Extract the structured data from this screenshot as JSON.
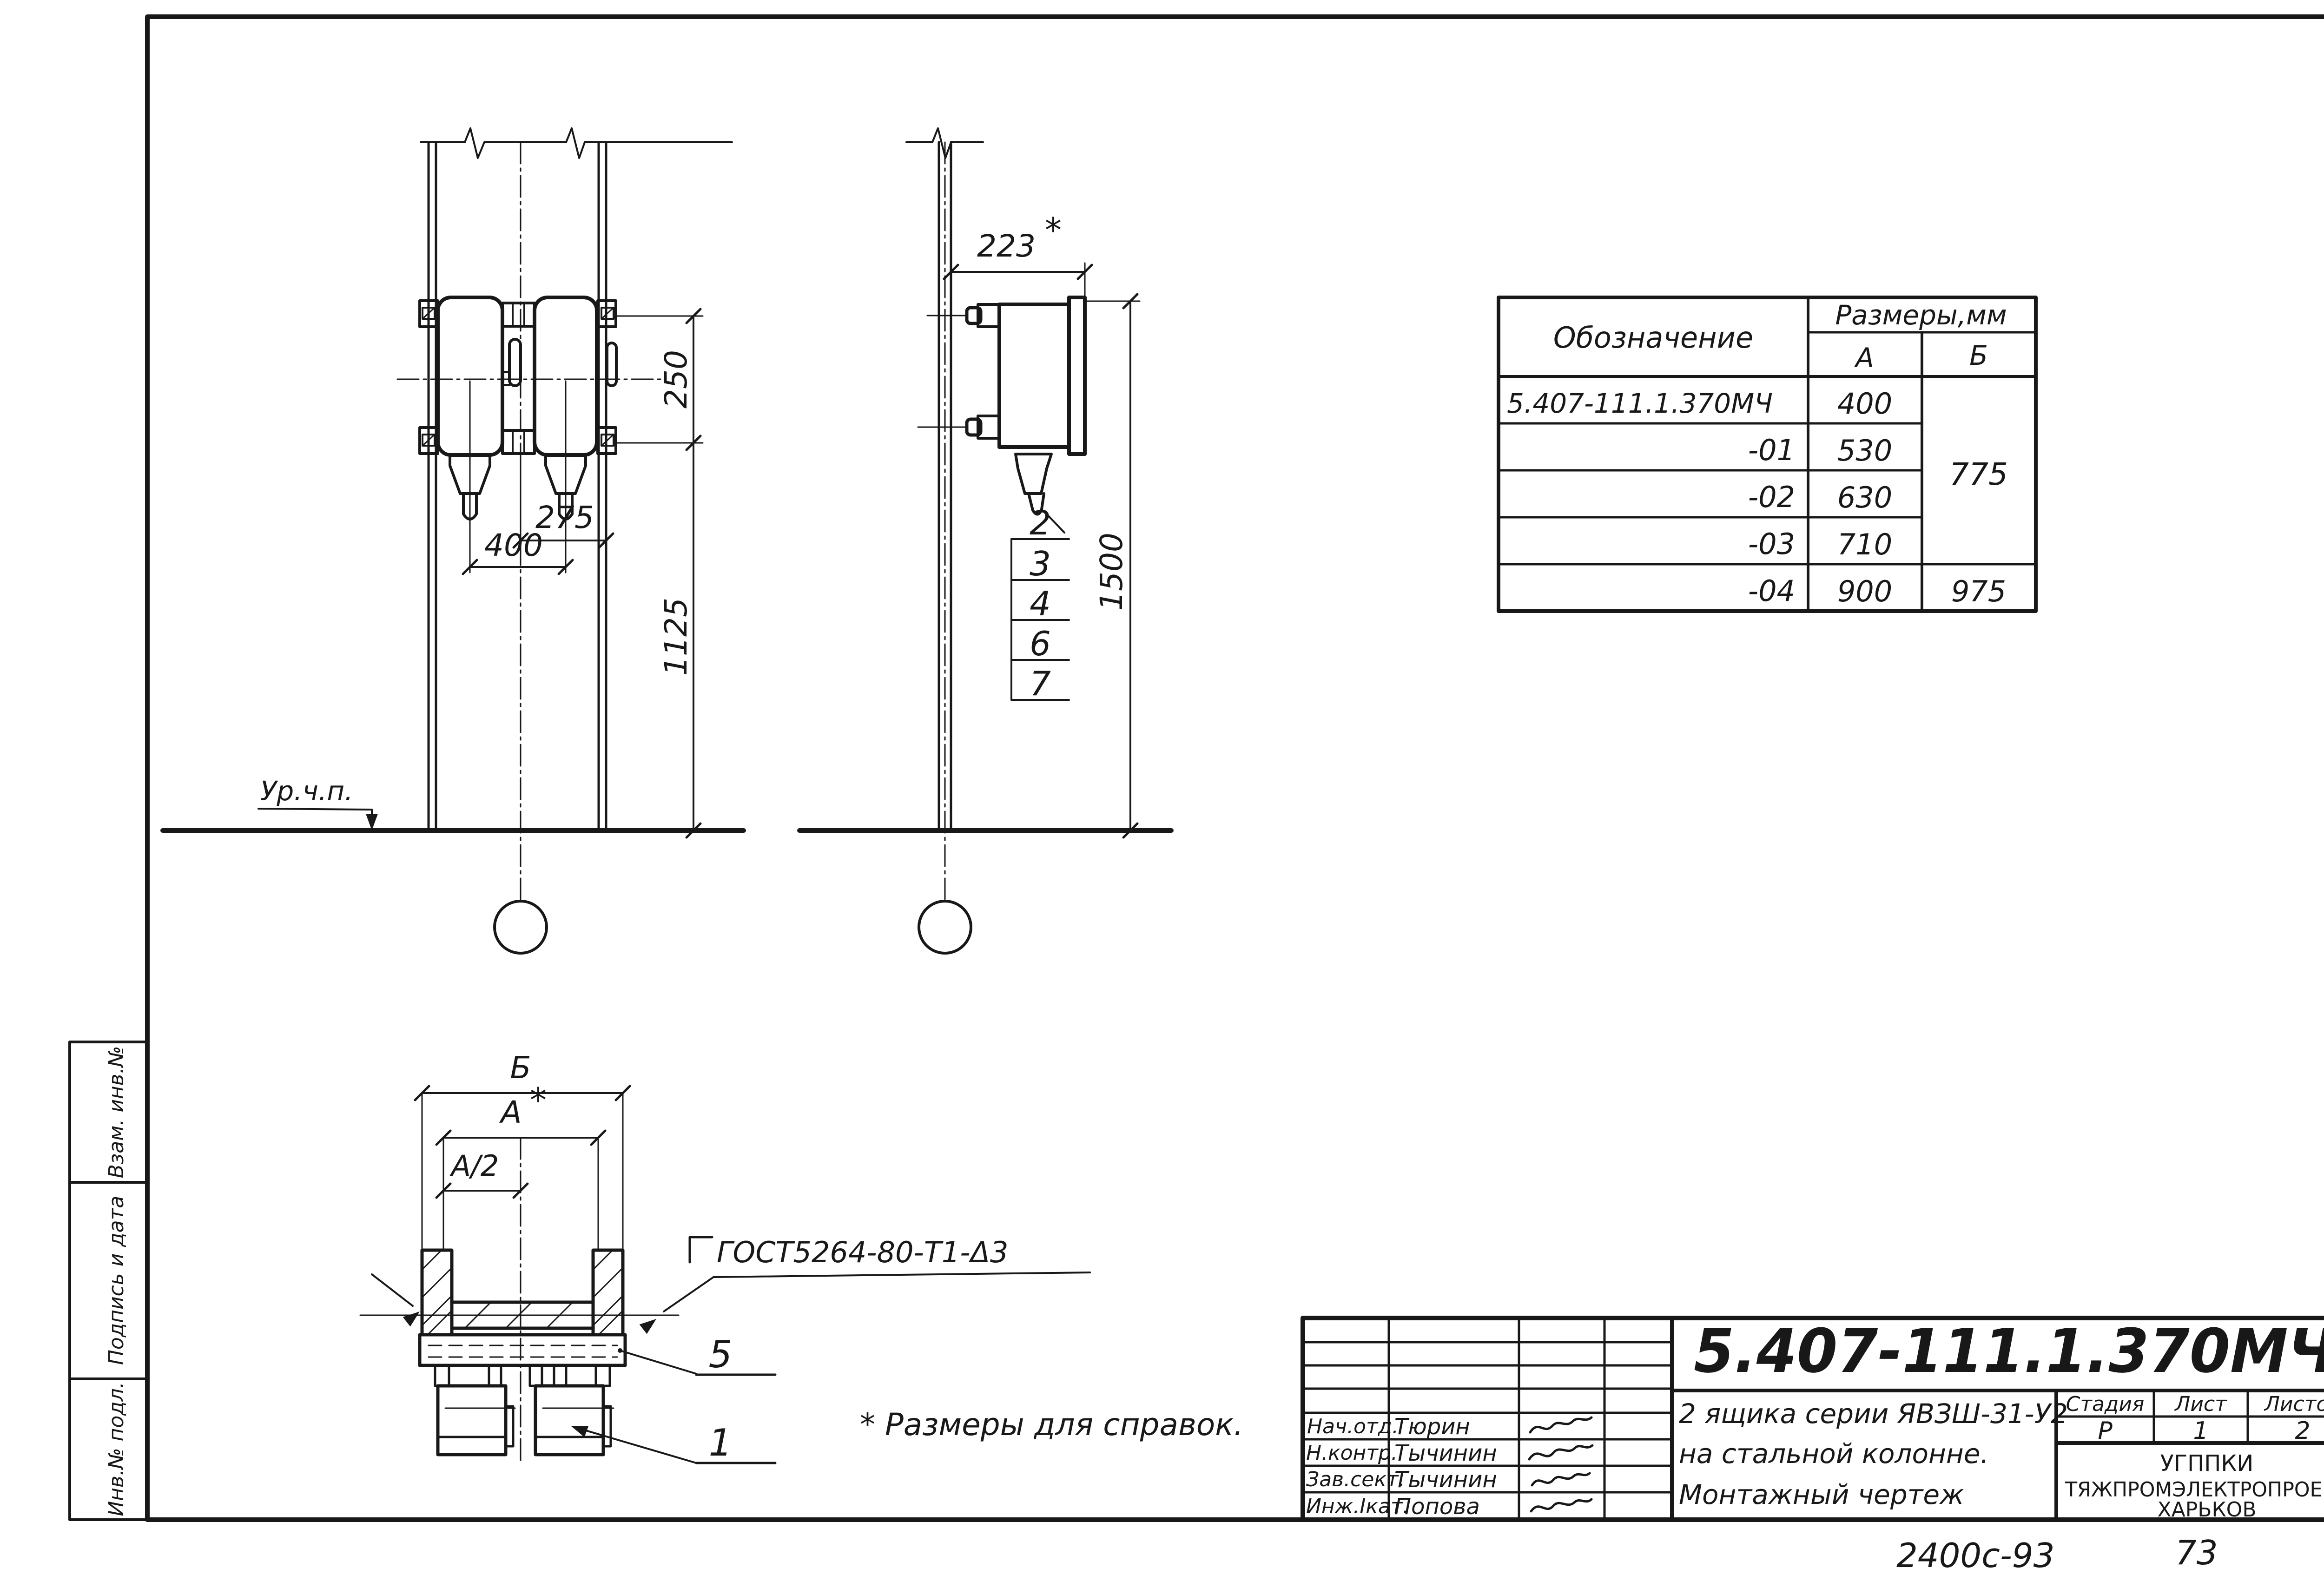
{
  "sheet": {
    "note": "* Размеры для справок.",
    "catalog_code": "2400с-93",
    "page_number": "73"
  },
  "margin_stamp": {
    "cells": [
      "Взам. инв.№",
      "Подпись и дата",
      "Инв.№ подл."
    ]
  },
  "dimensions_table": {
    "col_designation": "Обозначение",
    "col_sizes": "Размеры,мм",
    "col_a": "А",
    "col_b": "Б",
    "b_merged": "775",
    "rows": [
      {
        "designation": "5.407-111.1.370МЧ",
        "a": "400"
      },
      {
        "designation": "-01",
        "a": "530"
      },
      {
        "designation": "-02",
        "a": "630"
      },
      {
        "designation": "-03",
        "a": "710"
      },
      {
        "designation": "-04",
        "a": "900",
        "b": "975"
      }
    ]
  },
  "front_view": {
    "dims": {
      "v250": "250",
      "v275": "275",
      "v400": "400",
      "v1125": "1125"
    },
    "ground_label": "Ур.ч.п."
  },
  "side_view": {
    "dims": {
      "v223": "223",
      "star": "*",
      "v1500": "1500"
    },
    "callouts": [
      "2",
      "3",
      "4",
      "6",
      "7"
    ]
  },
  "section_view": {
    "labels": {
      "b": "Б",
      "a": "А",
      "star": "*",
      "a_half": "А/2"
    },
    "weld_note": "ГОСТ5264-80-Т1-Δ3",
    "callouts": [
      "5",
      "1"
    ]
  },
  "title_block": {
    "document_number": "5.407-111.1.370МЧ",
    "title_lines": [
      "2 ящика серии ЯВЗШ-31-У2",
      "на стальной колонне.",
      "Монтажный чертеж"
    ],
    "stage_label": "Стадия",
    "sheet_label": "Лист",
    "sheets_label": "Листов",
    "stage": "Р",
    "sheet": "1",
    "sheets": "2",
    "org_lines": [
      "УГППКИ",
      "ТЯЖПРОМЭЛЕКТРОПРОЕКТ",
      "ХАРЬКОВ"
    ],
    "signature_rows": [
      {
        "role": "Нач.отд.",
        "name": "Тюрин"
      },
      {
        "role": "Н.контр.",
        "name": "Тычинин"
      },
      {
        "role": "Зав.сект.",
        "name": "Тычинин"
      },
      {
        "role": "Инж.Iкат.",
        "name": "Попова"
      }
    ]
  },
  "colors": {
    "ink": "#181818",
    "paper": "#ffffff"
  }
}
